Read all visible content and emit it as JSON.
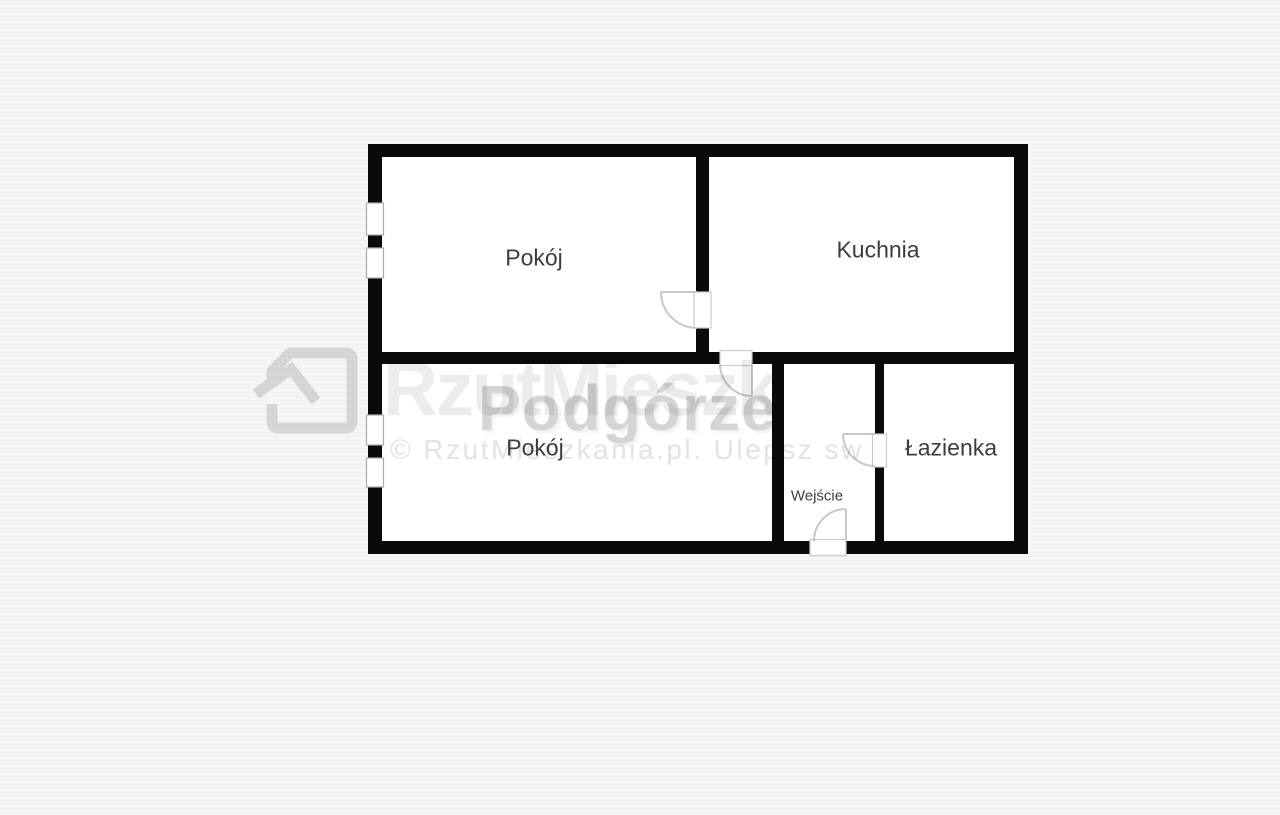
{
  "page": {
    "type": "apartment floor plan image",
    "background_color": "#f7f7f8"
  },
  "floorplan": {
    "wall_color": "#0a0a0a",
    "room_fill": "#ffffff",
    "label_color": "#3d3d3d",
    "door_stroke": "#c8c8c8",
    "window_stroke": "#ababab",
    "rooms": [
      {
        "id": "room-top",
        "label": "Pokój"
      },
      {
        "id": "kitchen",
        "label": "Kuchnia"
      },
      {
        "id": "room-bottom",
        "label": "Pokój"
      },
      {
        "id": "entrance-hall",
        "label": "Wejście"
      },
      {
        "id": "bathroom",
        "label": "Łazienka"
      }
    ],
    "features": {
      "windows": 2,
      "interior_doors": 3,
      "entrance_doors": 1
    }
  },
  "watermark": {
    "logo_icon": "house-logo-icon",
    "background_text": "RzutMieszk",
    "district_text": "Podgórze",
    "copyright_text": "© RzutMieszkania.pl. Ulepsz sw",
    "district_color": "#d5d5d5",
    "faint_color": "#ececec",
    "copyright_color": "#e3e3e3",
    "logo_color": "#dedede"
  }
}
